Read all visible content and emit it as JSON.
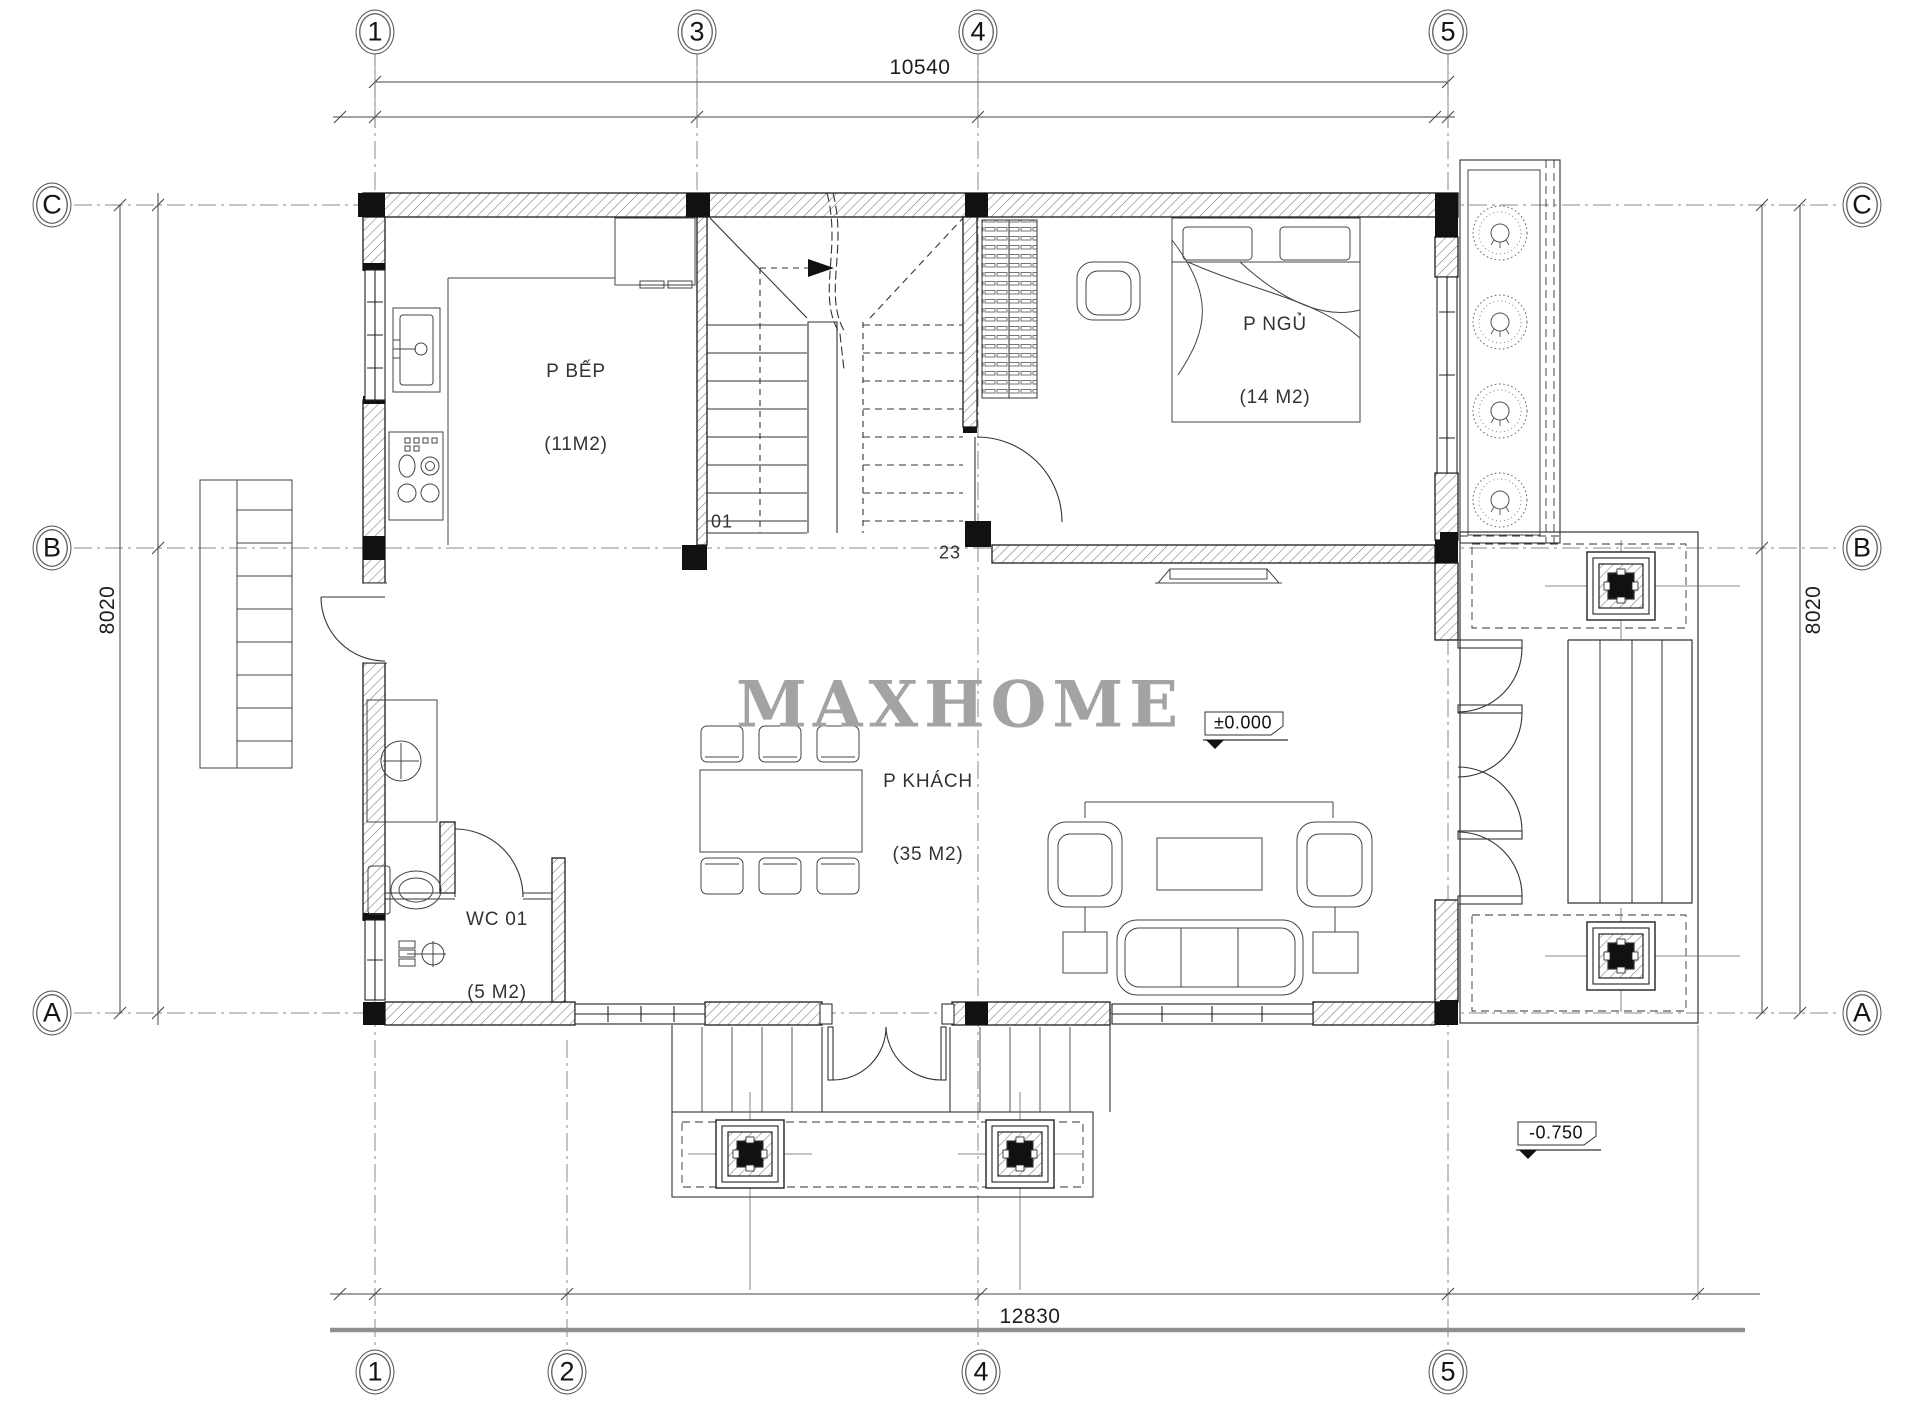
{
  "watermark": "MAXHOME",
  "grid": {
    "top": [
      "1",
      "3",
      "4",
      "5"
    ],
    "bottom": [
      "1",
      "2",
      "4",
      "5"
    ],
    "left": [
      "C",
      "B",
      "A"
    ],
    "right": [
      "C",
      "B",
      "A"
    ]
  },
  "dims": {
    "top": "10540",
    "bottom": "12830",
    "left": "8020",
    "right": "8020"
  },
  "rooms": {
    "kitchen": {
      "name": "P BẾP",
      "area": "(11M2)"
    },
    "bedroom": {
      "name": "P NGỦ",
      "area": "(14 M2)"
    },
    "living": {
      "name": "P KHÁCH",
      "area": "(35 M2)"
    },
    "wc": {
      "name": "WC 01",
      "area": "(5 M2)"
    }
  },
  "levels": {
    "main": "±0.000",
    "porch": "-0.750"
  },
  "stairs": {
    "lower": "01",
    "upper": "23"
  },
  "colors": {
    "line": "#1f1f1f",
    "watermark": "#a3a3a3",
    "hatch": "#777777",
    "grid": "#8a8a8a"
  }
}
